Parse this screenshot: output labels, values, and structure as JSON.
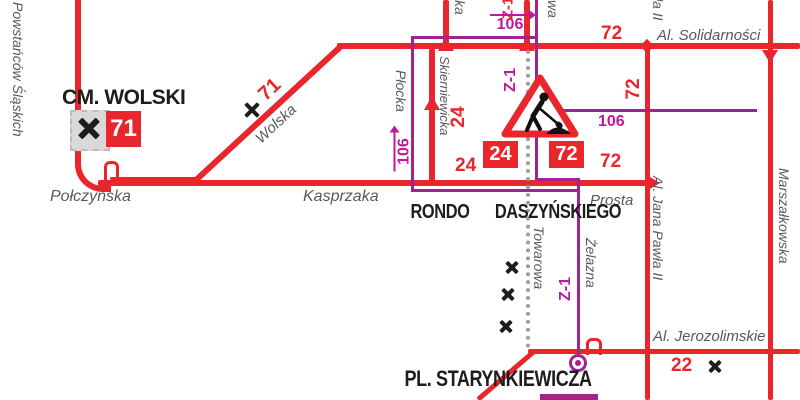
{
  "map": {
    "stops": {
      "cm_wolski": "CM. WOLSKI",
      "rondo_line1": "RONDO",
      "rondo_line2": "DASZYŃSKIEGO",
      "pl_starynkiewicza": "PL. STARYNKIEWICZA"
    },
    "streets": {
      "powstancow_slaskich": "Powstańców Śląskich",
      "polczynska": "Połczyńska",
      "wolska": "Wolska",
      "kasprzaka": "Kasprzaka",
      "plocka": "Płocka",
      "skierniewicka": "Skierniewicka",
      "towarowa": "Towarowa",
      "zelazna": "Żelazna",
      "prosta": "Prosta",
      "al_solidarnosci": "Al. Solidarności",
      "al_jana_pawla": "Al. Jana Pawła II",
      "al_jana_pawla_top_fragment": "ła II",
      "marszalkowska": "Marszałkowska",
      "al_jerozolimskie": "Al. Jerozolimskie",
      "top_fragment_ka": "ka",
      "top_fragment_wa": "wa"
    },
    "routes": {
      "r71": "71",
      "r24": "24",
      "r72": "72",
      "r22": "22",
      "r106": "106",
      "z1": "Z-1"
    },
    "colors": {
      "tram_red": "#e8262c",
      "bus_purple": "#a3238e",
      "label_magenta": "#c0189a",
      "street_gray": "#58585b",
      "stop_black": "#1d1d1b",
      "closed_dotted_gray": "#9d9d9c"
    }
  }
}
